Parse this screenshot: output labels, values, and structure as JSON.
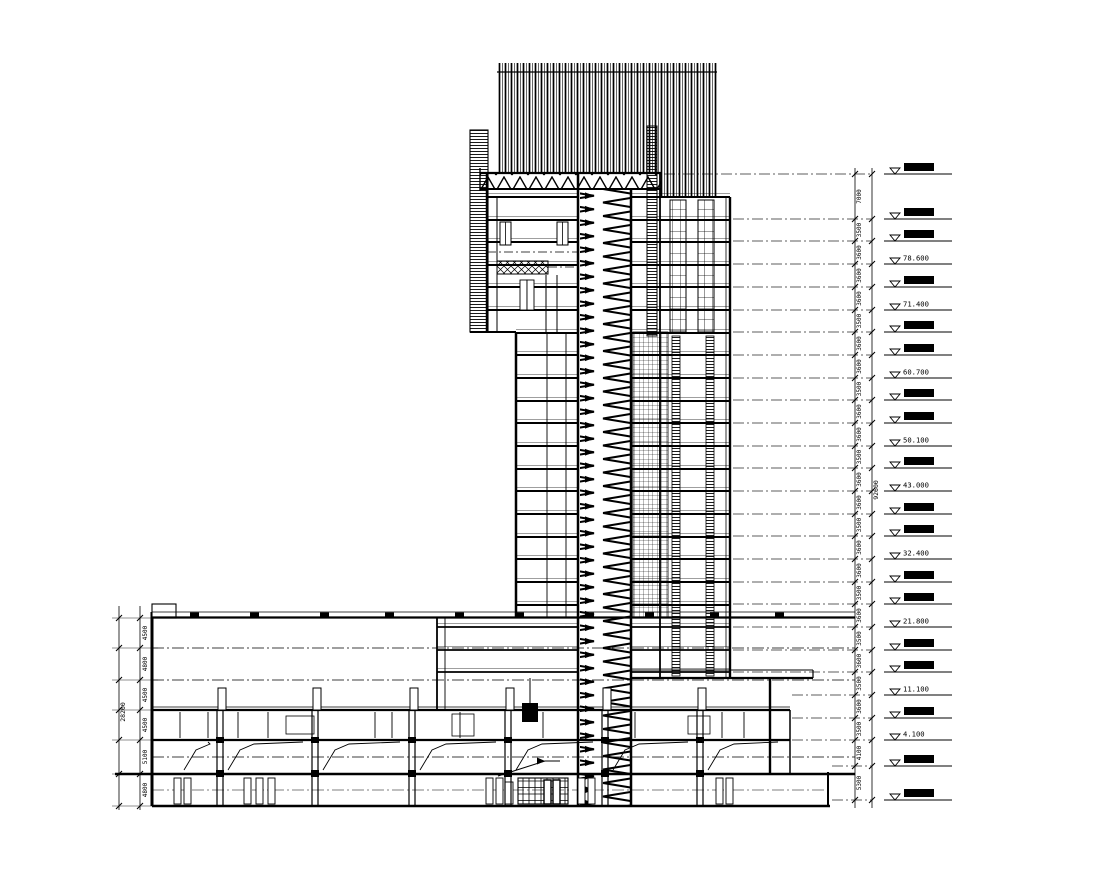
{
  "drawing": {
    "ink": "#000000",
    "paper": "#ffffff"
  },
  "levels": {
    "markers": [
      {
        "y": 174,
        "label": "",
        "style": "solid"
      },
      {
        "y": 219,
        "label": "",
        "style": "solid"
      },
      {
        "y": 241,
        "label": "",
        "style": "solid"
      },
      {
        "y": 264,
        "label": "78.600",
        "style": "text"
      },
      {
        "y": 287,
        "label": "",
        "style": "solid"
      },
      {
        "y": 310,
        "label": "71.400",
        "style": "text"
      },
      {
        "y": 332,
        "label": "",
        "style": "solid"
      },
      {
        "y": 355,
        "label": "",
        "style": "solid"
      },
      {
        "y": 378,
        "label": "60.700",
        "style": "text"
      },
      {
        "y": 400,
        "label": "",
        "style": "solid"
      },
      {
        "y": 423,
        "label": "",
        "style": "solid"
      },
      {
        "y": 446,
        "label": "50.100",
        "style": "text"
      },
      {
        "y": 468,
        "label": "",
        "style": "solid"
      },
      {
        "y": 491,
        "label": "43.000",
        "style": "text"
      },
      {
        "y": 514,
        "label": "",
        "style": "solid"
      },
      {
        "y": 536,
        "label": "",
        "style": "solid"
      },
      {
        "y": 559,
        "label": "32.400",
        "style": "text"
      },
      {
        "y": 582,
        "label": "",
        "style": "solid"
      },
      {
        "y": 604,
        "label": "",
        "style": "solid"
      },
      {
        "y": 627,
        "label": "21.800",
        "style": "text"
      },
      {
        "y": 650,
        "label": "",
        "style": "solid"
      },
      {
        "y": 672,
        "label": "",
        "style": "solid"
      },
      {
        "y": 695,
        "label": "11.100",
        "style": "text"
      },
      {
        "y": 718,
        "label": "",
        "style": "solid"
      },
      {
        "y": 740,
        "label": "4.100",
        "style": "text"
      },
      {
        "y": 766,
        "label": "",
        "style": "solid"
      },
      {
        "y": 800,
        "label": "",
        "style": "solid"
      }
    ]
  },
  "right_dims": {
    "segments": [
      "7000",
      "3500",
      "3600",
      "3600",
      "3600",
      "3500",
      "3600",
      "3600",
      "3500",
      "3600",
      "3600",
      "3500",
      "3600",
      "3600",
      "3500",
      "3600",
      "3600",
      "3500",
      "3600",
      "3500",
      "3600",
      "3500",
      "3600",
      "3500",
      "4100",
      "5300"
    ],
    "total": "92600"
  },
  "left_dims": {
    "segments": [
      "4500",
      "4800",
      "4500",
      "4500",
      "5100",
      "4800"
    ],
    "total": "28200"
  },
  "structure": {
    "tower_floor_ys": [
      197,
      220,
      242,
      265,
      287,
      310,
      333,
      355,
      378,
      401,
      423,
      446,
      469,
      491,
      514,
      537,
      559,
      582,
      605,
      627,
      650,
      672
    ],
    "podium_floor_ys": [
      618,
      648,
      680,
      710,
      740,
      774,
      806
    ],
    "roof_tick_xs": [
      190,
      250,
      320,
      385,
      455,
      515,
      585,
      645,
      710,
      775
    ],
    "clerestory_xs": [
      222,
      317,
      414,
      510,
      607,
      702
    ],
    "column_xs": [
      220,
      315,
      412,
      508,
      605,
      700
    ],
    "ramp_bay_xs": [
      176,
      220,
      315,
      412,
      508,
      605,
      700,
      790
    ],
    "room_wall_xs": [
      180,
      208,
      238,
      268,
      375,
      392,
      460,
      543,
      635,
      722,
      744
    ],
    "equipment_xs": [
      174,
      184,
      244,
      256,
      268,
      486,
      496,
      578,
      588,
      716,
      726
    ]
  }
}
